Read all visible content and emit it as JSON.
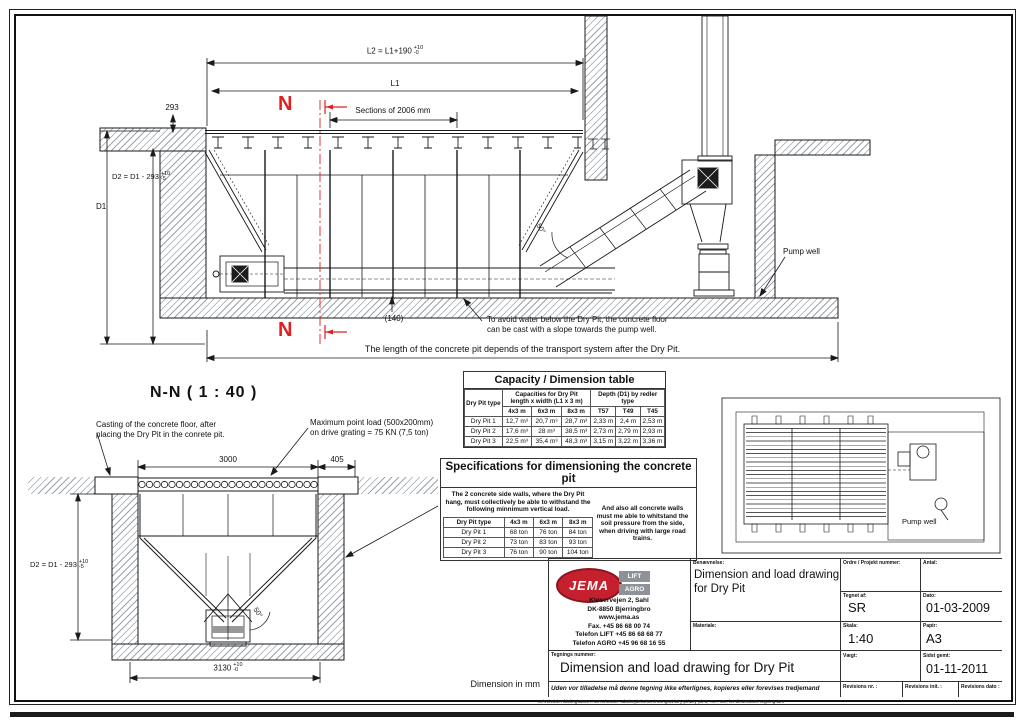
{
  "page": {
    "file_path": "M:\\Teknisk Afdeling\\JEMA AGRO\\Under udarbejdelse\\SA\\Korngrav\\Dry pit\\Dry-pit 3, T57, 6m, for dimensione tegning.iam",
    "dimension_note": "Dimension in mm"
  },
  "side_view": {
    "dim_l2": "L2 = L1+190",
    "dim_l2_tol_up": "+10",
    "dim_l2_tol_dn": "-0",
    "dim_l1": "L1",
    "dim_293": "293",
    "sections_note": "Sections of 2006 mm",
    "n_marker": "N",
    "dim_d2": "D2 = D1 - 293",
    "dim_d2_tol_up": "+10",
    "dim_d2_tol_dn": "-5",
    "dim_d1": "D1",
    "dim_140": "(140)",
    "angle": "50°",
    "pump_well": "Pump well",
    "note_water_1": "To avoid water below the Dry Pit, the concrete floor",
    "note_water_2": "can be cast with a slope towards the pump well.",
    "note_length": "The length of the concrete pit depends of the transport system after the Dry Pit."
  },
  "section_view": {
    "title": "N-N  ( 1 : 40 )",
    "note_casting_1": "Casting of the concrete floor, after",
    "note_casting_2": "placing the Dry Pit in the conrete pit.",
    "note_load_1": "Maximum point load (500x200mm)",
    "note_load_2": "on drive grating = 75 KN (7,5 ton)",
    "dim_3000": "3000",
    "dim_405": "405",
    "dim_d2": "D2 = D1 - 293",
    "dim_d2_tol_up": "+10",
    "dim_d2_tol_dn": "-5",
    "angle": "50°",
    "dim_3130": "3130",
    "dim_3130_tol_up": "+10",
    "dim_3130_tol_dn": "-0"
  },
  "capacity_table": {
    "title": "Capacity / Dimension table",
    "col_type": "Dry Pit type",
    "group_capacity_1": "Capacities for Dry Pit",
    "group_capacity_2": "length x width (L1 x 3 m)",
    "group_depth_1": "Depth (D1) by redler",
    "group_depth_2": "type",
    "sub": [
      "4x3 m",
      "6x3 m",
      "8x3 m",
      "T57",
      "T49",
      "T45"
    ],
    "rows": [
      [
        "Dry Pit 1",
        "12,7 m³",
        "20,7 m³",
        "28,7 m³",
        "2,33 m",
        "2,4 m",
        "2,53 m"
      ],
      [
        "Dry Pit 2",
        "17,6 m³",
        "28 m³",
        "38,5 m³",
        "2,73 m",
        "2,79 m",
        "2,93 m"
      ],
      [
        "Dry Pit 3",
        "22,5 m³",
        "35,4 m³",
        "48,3 m³",
        "3,15 m",
        "3,22 m",
        "3,36 m"
      ]
    ]
  },
  "spec_table": {
    "title": "Specifications for dimensioning the concrete pit",
    "note_left": "The 2 concrete side walls, where the Dry Pit hang, must collectively be able to withstand the following minnimum vertical load.",
    "note_right": "And also all concrete walls must me able to whitstand the soil pressure from the side, when driving with large road trains.",
    "headers": [
      "Dry Pit type",
      "4x3 m",
      "6x3 m",
      "8x3 m"
    ],
    "rows": [
      [
        "Dry Pit 1",
        "68 ton",
        "76 ton",
        "84 ton"
      ],
      [
        "Dry Pit 2",
        "73 ton",
        "83 ton",
        "93 ton"
      ],
      [
        "Dry Pit 3",
        "76 ton",
        "90 ton",
        "104 ton"
      ]
    ]
  },
  "plan_view": {
    "pump_well": "Pump well"
  },
  "title_block": {
    "logo_text": "JEMA",
    "logo_lift": "LIFT",
    "logo_agro": "AGRO",
    "address": [
      "Kløservejen 2, Sahl",
      "DK-8850 Bjerringbro",
      "www.jema.as",
      "Fax. +45 86 68 00 74",
      "Telefon LIFT   +45 86 68 68 77",
      "Telefon AGRO +45 96 68 16 55"
    ],
    "labels": {
      "benaevnelse": "Benævnelse:",
      "ordre": "Ordre / Projekt nummer:",
      "antal": "Antal:",
      "tegnet_af": "Tegnet af:",
      "dato": "Dato:",
      "materiale": "Materiale:",
      "skala": "Skala:",
      "papir": "Papir:",
      "vaegt": "Vægt:",
      "sidst_gemt": "Sidst gemt:",
      "tegnings_nummer": "Tegnings nummer:",
      "rev_nr": "Revisions nr. :",
      "rev_init": "Revisions init. :",
      "rev_dato": "Revisions dato :"
    },
    "values": {
      "benaevnelse_1": "Dimension and load drawing",
      "benaevnelse_2": "for Dry Pit",
      "tegnet_af": "SR",
      "dato": "01-03-2009",
      "skala": "1:40",
      "papir": "A3",
      "sidst_gemt": "01-11-2011",
      "tegnings_nummer": "Dimension and load drawing for Dry Pit"
    },
    "footer": "Uden vor tilladelse må denne tegning ikke efterlignes, kopieres eller forevises tredjemand"
  },
  "colors": {
    "accent_red": "#e02020",
    "logo_red": "#c4202e",
    "logo_gray": "#8d9298",
    "line": "#1a1a1a",
    "hatch": "#9aa3ad"
  }
}
